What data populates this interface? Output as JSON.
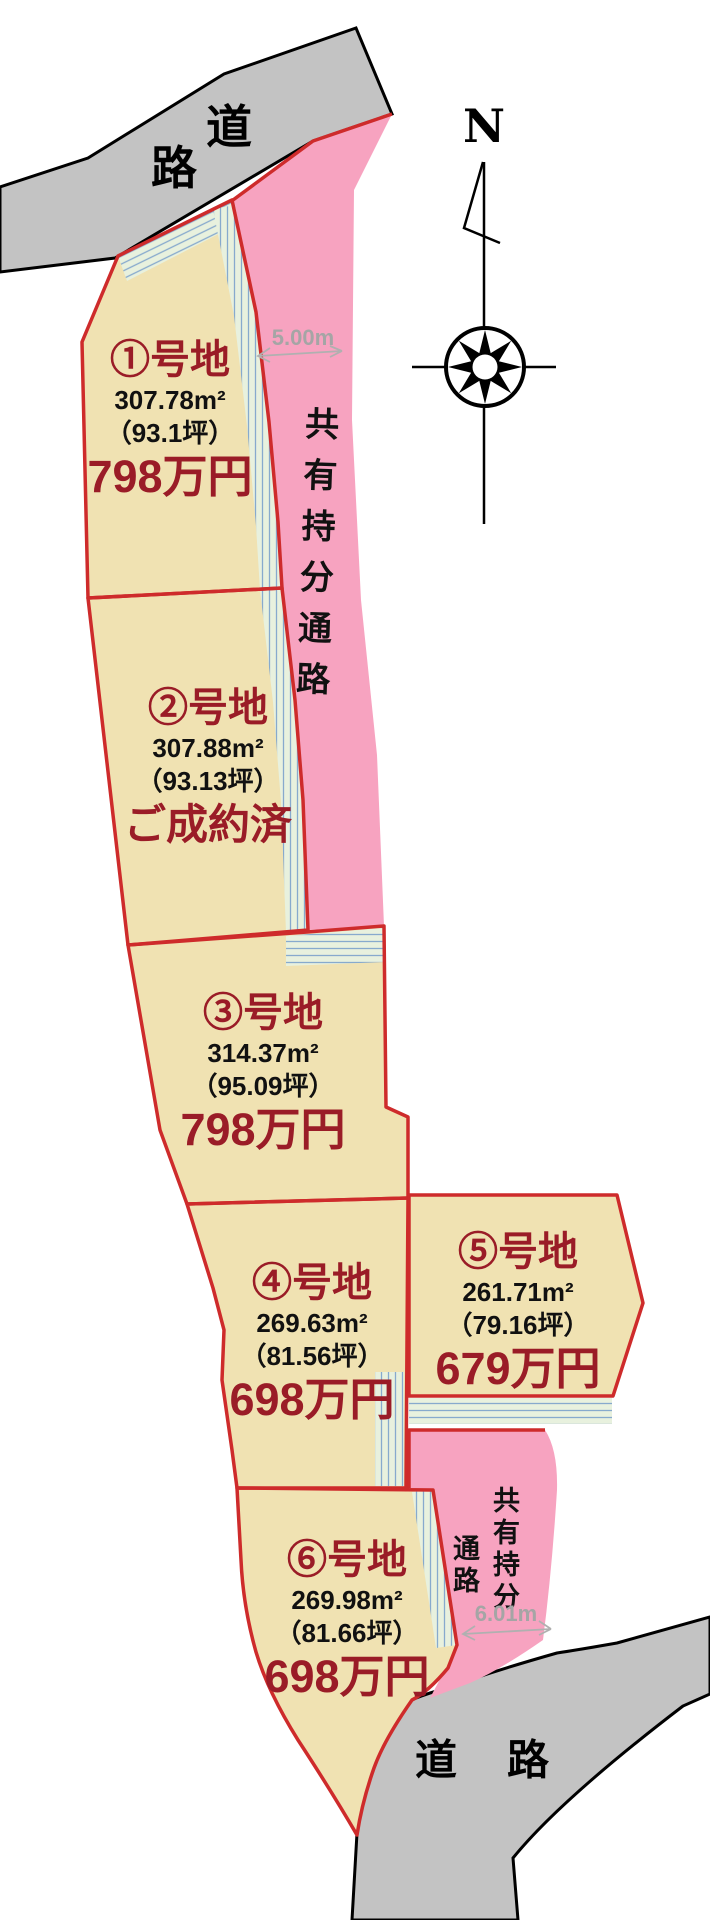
{
  "map": {
    "compass": {
      "label": "N"
    },
    "roads": {
      "top": {
        "chars": [
          "道",
          "路"
        ]
      },
      "bottom": {
        "label": "道　路"
      }
    },
    "paths": {
      "top": {
        "label": "共有持分通路",
        "width_label": "5.00m"
      },
      "bottom": {
        "columns": [
          "共有持分",
          "通路"
        ],
        "width_label": "6.01m"
      }
    },
    "lots": [
      {
        "label": "①号地",
        "area": "307.78m²",
        "tsubo": "（93.1坪）",
        "price": "798万円"
      },
      {
        "label": "②号地",
        "area": "307.88m²",
        "tsubo": "（93.13坪）",
        "price": "ご成約済"
      },
      {
        "label": "③号地",
        "area": "314.37m²",
        "tsubo": "（95.09坪）",
        "price": "798万円"
      },
      {
        "label": "④号地",
        "area": "269.63m²",
        "tsubo": "（81.56坪）",
        "price": "698万円"
      },
      {
        "label": "⑤号地",
        "area": "261.71m²",
        "tsubo": "（79.16坪）",
        "price": "679万円"
      },
      {
        "label": "⑥号地",
        "area": "269.98m²",
        "tsubo": "（81.66坪）",
        "price": "698万円"
      }
    ],
    "colors": {
      "road_gray": "#c3c3c3",
      "path_pink": "#f7a3c0",
      "lot_tan": "#f0e2b2",
      "boundary_red": "#ce2b2b",
      "label_maroon": "#9a1c27",
      "band_green": "#e8f1de",
      "band_line_blue": "#87aacd",
      "dimension_gray": "#a5a5a5"
    }
  }
}
